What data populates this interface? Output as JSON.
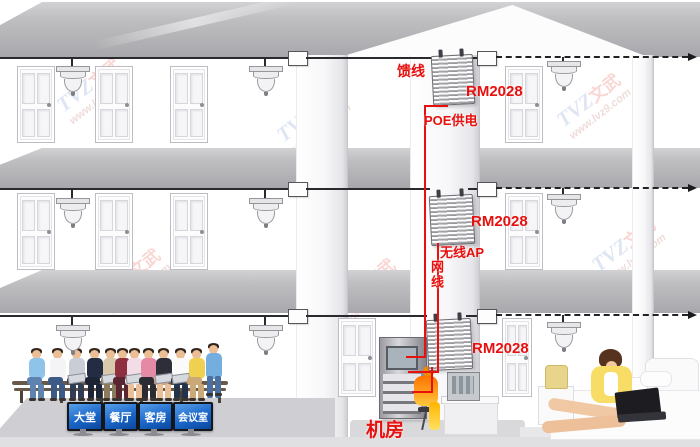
{
  "diagram": {
    "labels": {
      "feeder_line": "馈线",
      "device_model": "RM2028",
      "poe_power": "POE供电",
      "wireless_ap": "无线AP",
      "network_cable": "网线",
      "machine_room": "机房"
    },
    "room_signs": [
      "大堂",
      "餐厅",
      "客房",
      "会议室"
    ],
    "watermark": {
      "brand_latin": "TVZ",
      "brand_cn": "文武",
      "url": "www.lvz9.com"
    },
    "colors": {
      "label_red": "#e8100e",
      "sign_blue": "#1a66c8",
      "cable_black": "#2a2a2e",
      "silhouette_orange": "#ff7300"
    },
    "people_clothing": [
      {
        "shirt": "#8ec3ea",
        "pants": "#5f83b0"
      },
      {
        "shirt": "#f4f4f6",
        "pants": "#3c5a86"
      },
      {
        "shirt": "#c9cdd6",
        "pants": "#313d52"
      },
      {
        "shirt": "#232c42",
        "pants": "#1d2436"
      },
      {
        "shirt": "#d8c9ac",
        "pants": "#8a7a5e"
      },
      {
        "shirt": "#8e3040",
        "pants": "#5a2530"
      },
      {
        "shirt": "#f2dde6",
        "pants": "#e8e8ea"
      },
      {
        "shirt": "#e48aa6",
        "pants": "#2b2b33"
      },
      {
        "shirt": "#2e2e38",
        "pants": "#c8a27e"
      },
      {
        "shirt": "#fafafa",
        "pants": "#24324a"
      },
      {
        "shirt": "#f0d050",
        "pants": "#caa878"
      },
      {
        "shirt": "#74aede",
        "pants": "#4a6fa0"
      }
    ]
  }
}
